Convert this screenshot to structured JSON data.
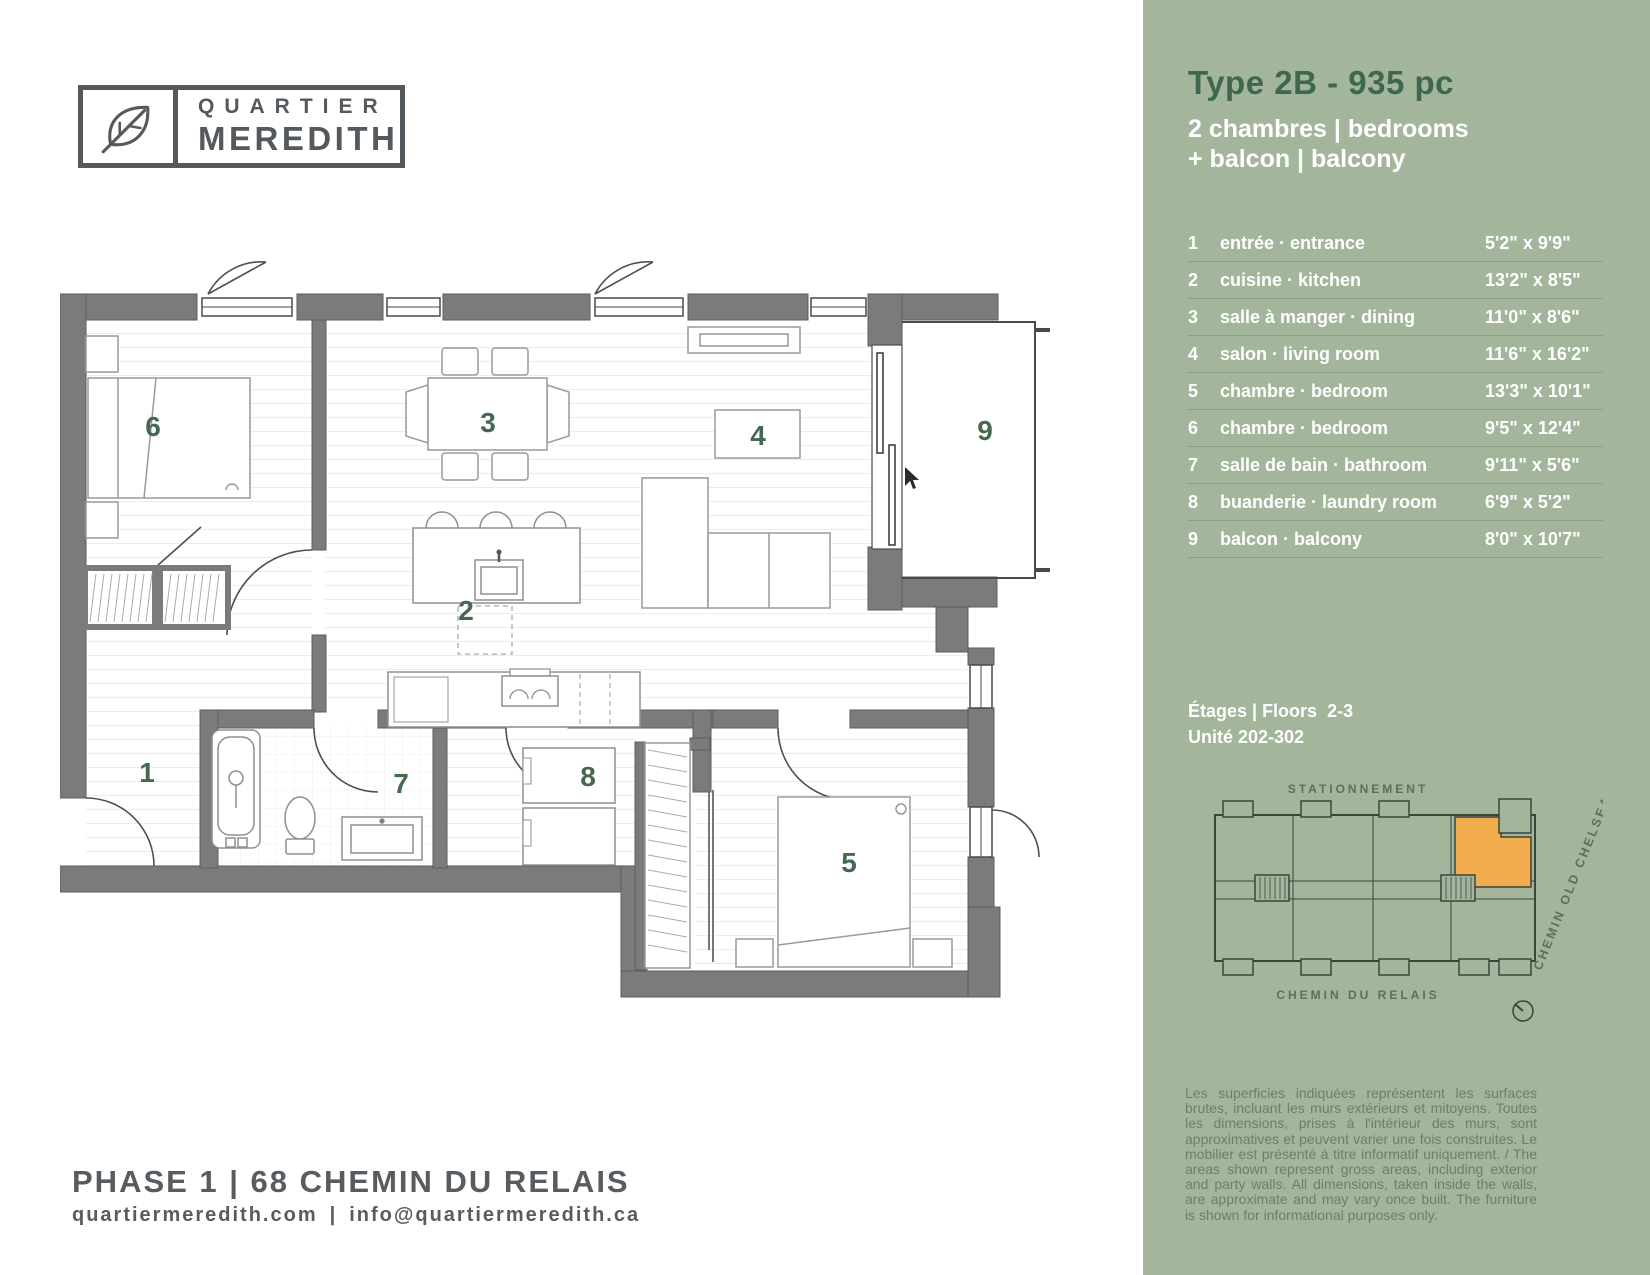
{
  "logo": {
    "line1": "QUARTIER",
    "line2": "MEREDITH"
  },
  "sidebar": {
    "bg_color": "#a3b69c",
    "title": "Type 2B - 935 pc",
    "title_color": "#3d684f",
    "subtitle_line1": "2 chambres | bedrooms",
    "subtitle_line2": "+ balcon | balcony",
    "rooms": [
      {
        "num": "1",
        "name": "entrée · entrance",
        "dims": "5'2\" x 9'9\""
      },
      {
        "num": "2",
        "name": "cuisine · kitchen",
        "dims": "13'2\" x 8'5\""
      },
      {
        "num": "3",
        "name": "salle à manger · dining",
        "dims": "11'0\" x 8'6\""
      },
      {
        "num": "4",
        "name": "salon · living room",
        "dims": "11'6\" x 16'2\""
      },
      {
        "num": "5",
        "name": "chambre · bedroom",
        "dims": "13'3\" x 10'1\""
      },
      {
        "num": "6",
        "name": "chambre · bedroom",
        "dims": "9'5\" x 12'4\""
      },
      {
        "num": "7",
        "name": "salle de bain · bathroom",
        "dims": "9'11\" x 5'6\""
      },
      {
        "num": "8",
        "name": "buanderie · laundry room",
        "dims": "6'9\" x 5'2\""
      },
      {
        "num": "9",
        "name": "balcon · balcony",
        "dims": "8'0\" x 10'7\""
      }
    ],
    "floors_label": "Étages | Floors  2-3",
    "unit_label": "Unité 202-302",
    "keyplan": {
      "street_top": "STATIONNEMENT",
      "street_bottom": "CHEMIN DU RELAIS",
      "street_right": "CHEMIN OLD CHELSEA",
      "highlight_color": "#f2ae4e"
    },
    "disclaimer": "Les superficies indiquées représentent les surfaces brutes, incluant les murs extérieurs et mitoyens. Toutes les dimensions, prises à l'intérieur des murs, sont approximatives et peuvent varier une fois construites. Le mobilier est présenté à titre informatif uniquement. / The areas shown represent gross areas, including exterior and party walls. All dimensions, taken inside the walls, are approximate and may vary once built. The furniture is shown for informational purposes only."
  },
  "floorplan": {
    "label_color": "#46684f",
    "wall_color": "#7b7b7b",
    "room_labels": {
      "r1": "1",
      "r2": "2",
      "r3": "3",
      "r4": "4",
      "r5": "5",
      "r6": "6",
      "r7": "7",
      "r8": "8",
      "r9": "9"
    }
  },
  "footer": {
    "address": "PHASE 1 | 68 CHEMIN DU RELAIS",
    "contact_web": "quartiermeredith.com",
    "contact_sep": "|",
    "contact_email": "info@quartiermeredith.ca"
  }
}
